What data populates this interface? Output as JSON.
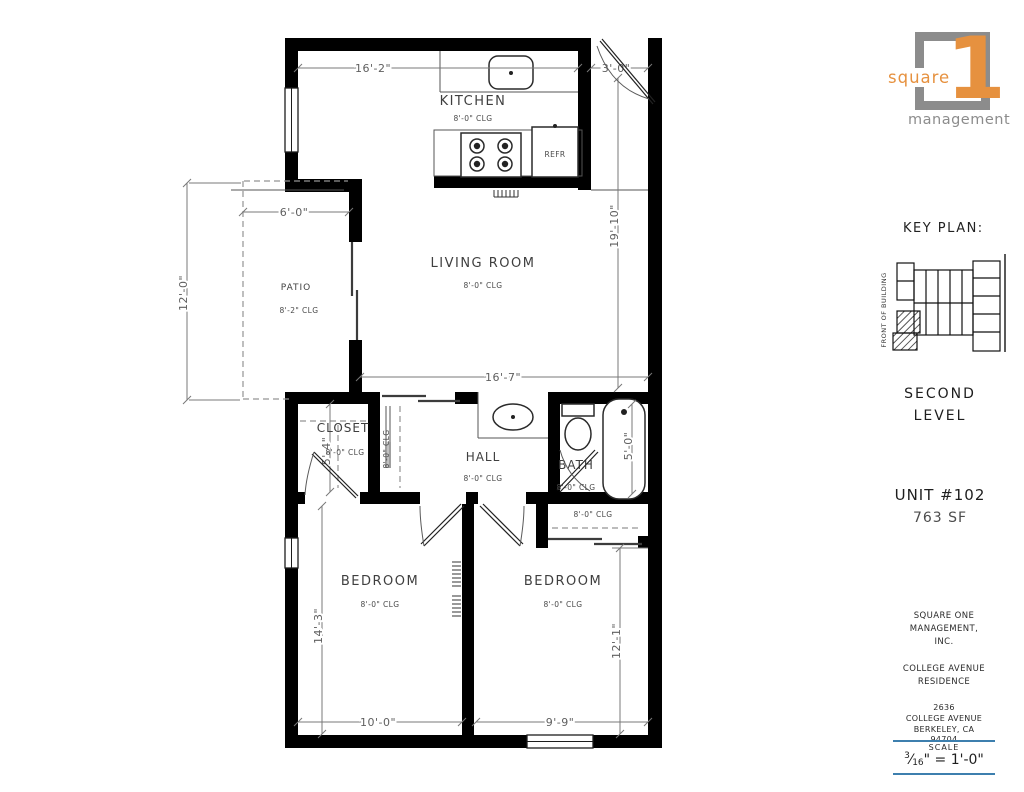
{
  "colors": {
    "accent_orange": "#e6913f",
    "logo_gray": "#8c8c8c",
    "line_blue": "#3d7fae",
    "wall_black": "#000000",
    "dim_gray": "#787878"
  },
  "logo": {
    "word_top": "square",
    "numeral": "1",
    "word_bottom": "management"
  },
  "sidebar": {
    "key_plan_title": "KEY PLAN:",
    "front_of_building": "FRONT OF BUILDING",
    "level_line1": "SECOND",
    "level_line2": "LEVEL",
    "unit_number": "UNIT #102",
    "unit_area": "763 SF",
    "company": [
      "SQUARE ONE",
      "MANAGEMENT,",
      "INC."
    ],
    "residence": [
      "COLLEGE AVENUE",
      "RESIDENCE"
    ],
    "address": [
      "2636",
      "COLLEGE AVENUE",
      "BERKELEY, CA",
      "94704"
    ],
    "scale": {
      "label": "SCALE",
      "num": "3",
      "den": "16",
      "slash": "⁄",
      "rest": "\" = 1'-0\""
    }
  },
  "plan": {
    "rooms": {
      "kitchen": {
        "name": "KITCHEN",
        "clg": "8'-0\" CLG"
      },
      "living": {
        "name": "LIVING ROOM",
        "clg": "8'-0\" CLG"
      },
      "patio": {
        "name": "PATIO",
        "clg": "8'-2\" CLG"
      },
      "closet": {
        "name": "CLOSET",
        "clg": "8'-0\" CLG"
      },
      "hall": {
        "name": "HALL",
        "clg": "8'-0\" CLG"
      },
      "bath": {
        "name": "BATH",
        "clg": "8'-0\" CLG"
      },
      "bedroom1": {
        "name": "BEDROOM",
        "clg": "8'-0\" CLG"
      },
      "bedroom2": {
        "name": "BEDROOM",
        "clg": "8'-0\" CLG"
      },
      "hall_closet_clg": "8'-0\" CLG",
      "bedroom2_closet_clg": "8'-0\" CLG"
    },
    "dims": {
      "kitchen_width": "16'-2\"",
      "entry_width": "3'-0\"",
      "living_length": "19'-10\"",
      "patio_width": "6'-0\"",
      "patio_depth": "12'-0\"",
      "living_width": "16'-7\"",
      "closet_depth": "5'-4\"",
      "bath_depth": "5'-0\"",
      "bedroom1_depth": "14'-3\"",
      "bedroom2_depth": "12'-1\"",
      "bedroom1_width": "10'-0\"",
      "bedroom2_width": "9'-9\""
    },
    "labels": {
      "refrigerator": "REFR"
    }
  }
}
